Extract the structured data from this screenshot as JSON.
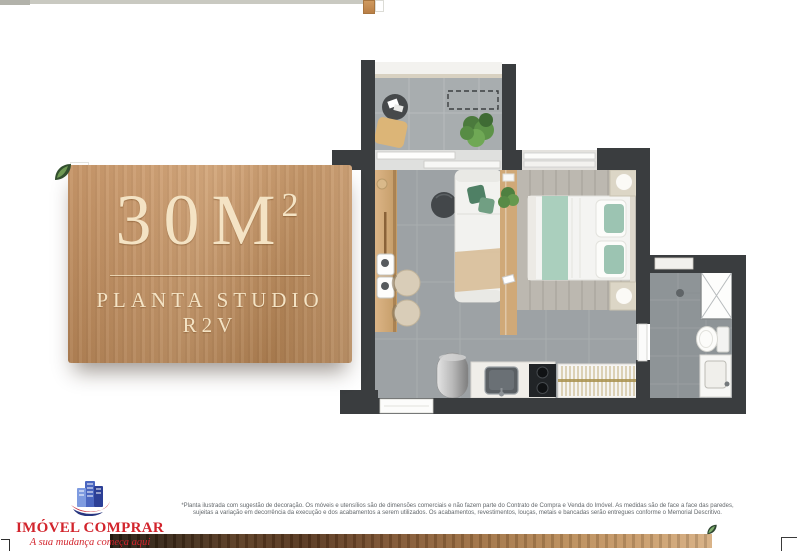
{
  "panel": {
    "area_base": "30M",
    "area_sup": "2",
    "area_full": "30M²",
    "plan_name": "PLANTA STUDIO R2V",
    "wood_color": "#c79467",
    "text_color": "#f4e3c4"
  },
  "brand": {
    "name": "IMÓVEL COMPRAR",
    "tagline": "A sua mudança começa aqui",
    "color": "#d2242c"
  },
  "disclaimer": {
    "line1": "*Planta ilustrada com sugestão de decoração. Os móveis e utensílios são de dimensões comerciais e não fazem parte do Contrato de Compra e Venda do Imóvel. As medidas são de face a face das paredes,",
    "line2": "sujeitas a variação em decorrência da execução e dos acabamentos a serem utilizados. Os acabamentos, revestimentos, louças, metais e bancadas serão entregues conforme o Memorial Descritivo."
  },
  "floorplan": {
    "wall_color": "#3a3d3f",
    "balcony_floor": "#a8adaf",
    "living_floor": "#9da2a5",
    "bedroom_floor": "#bcb8b0",
    "bathroom_floor": "#8e9497",
    "wood_furniture": "#d0a978",
    "sage_green": "#aacfbd",
    "plant_green": "#4d7c3f",
    "gold": "#b39c5a",
    "icons": [
      "leaf-icon-top-left",
      "leaf-icon-bottom-right",
      "buildings-logo-icon"
    ]
  }
}
